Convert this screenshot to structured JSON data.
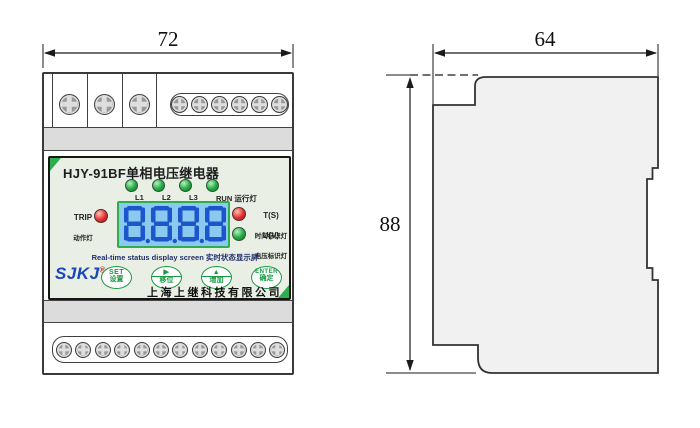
{
  "drawing": {
    "front_view": {
      "width_dim": "72",
      "terminals": {
        "top_large_count": 3,
        "top_small_count": 6,
        "bottom_small_count": 12
      },
      "panel": {
        "title": "HJY-91BF单相电压继电器",
        "indicator_leds": [
          {
            "label": "L1",
            "color": "green"
          },
          {
            "label": "L2",
            "color": "green"
          },
          {
            "label": "L3",
            "color": "green"
          },
          {
            "label": "RUN 运行灯",
            "color": "green"
          }
        ],
        "trip_led": {
          "label_en": "TRIP",
          "label_zh": "动作灯",
          "color": "red"
        },
        "time_led": {
          "label_en": "T(S)",
          "label_zh": "时间标识灯",
          "color": "red"
        },
        "voltage_led": {
          "label_en": "U(V)",
          "label_zh": "电压标识灯",
          "color": "green"
        },
        "lcd": {
          "value": "8.8.8.8",
          "caption": "Real-time status display screen 实时状态显示屏"
        },
        "logo": {
          "text": "SJKJ",
          "reg": "®"
        },
        "buttons": [
          {
            "top": "SET",
            "bottom": "设置"
          },
          {
            "top": "▶",
            "bottom": "移位"
          },
          {
            "top": "▲",
            "bottom": "增加"
          },
          {
            "top": "ENTER",
            "bottom": "确定"
          }
        ],
        "company": "上海上继科技有限公司"
      }
    },
    "side_view": {
      "width_dim": "64",
      "height_dim": "88"
    },
    "colors": {
      "accent_green": "#2fae4e",
      "button_green": "#169a43",
      "lcd_bg": "#8cc9f0",
      "lcd_digit": "#1d55cc",
      "logo_blue": "#1847b8",
      "led_red": "#e23030",
      "led_green": "#22a844",
      "panel_bg": "#e9efe4"
    }
  }
}
